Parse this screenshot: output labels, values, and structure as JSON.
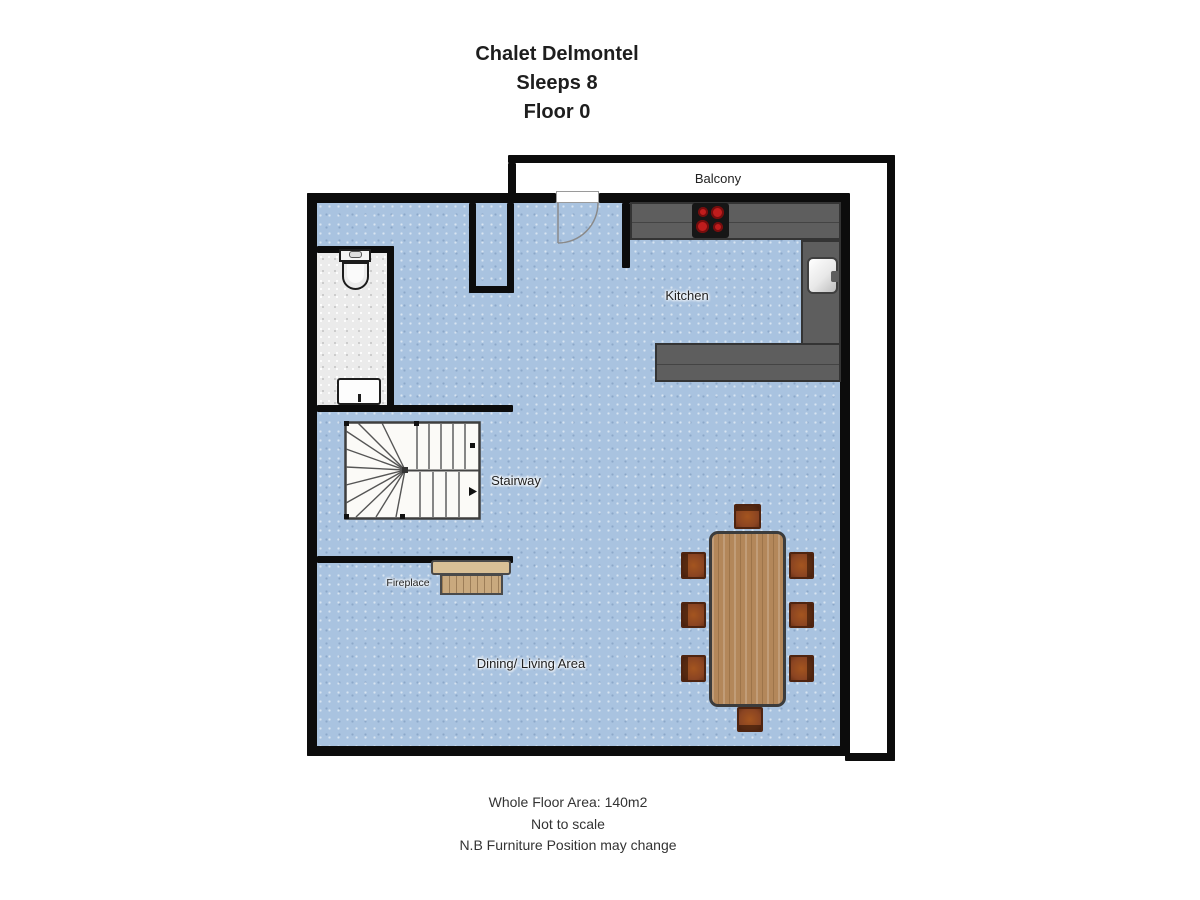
{
  "header": {
    "title": "Chalet Delmontel",
    "sleeps": "Sleeps 8",
    "floor": "Floor 0"
  },
  "labels": {
    "balcony": "Balcony",
    "kitchen": "Kitchen",
    "stairway": "Stairway",
    "fireplace": "Fireplace",
    "dining_living": "Dining/ Living Area"
  },
  "footer": {
    "line1": "Whole Floor Area: 140m2",
    "line2": "Not to scale",
    "line3": "N.B Furniture Position may change"
  },
  "colors": {
    "floor_blue": "#a9c3e0",
    "wall_black": "#0c0c0c",
    "counter_gray": "#5e5e5e",
    "bathroom_tile": "#ebebeb",
    "balcony_white": "#ffffff",
    "table_wood": "#b3875a",
    "chair_wood": "#8a4422",
    "fireplace_tan": "#d9c096",
    "stove_black": "#161616",
    "burner_red": "#bf1d1d"
  }
}
